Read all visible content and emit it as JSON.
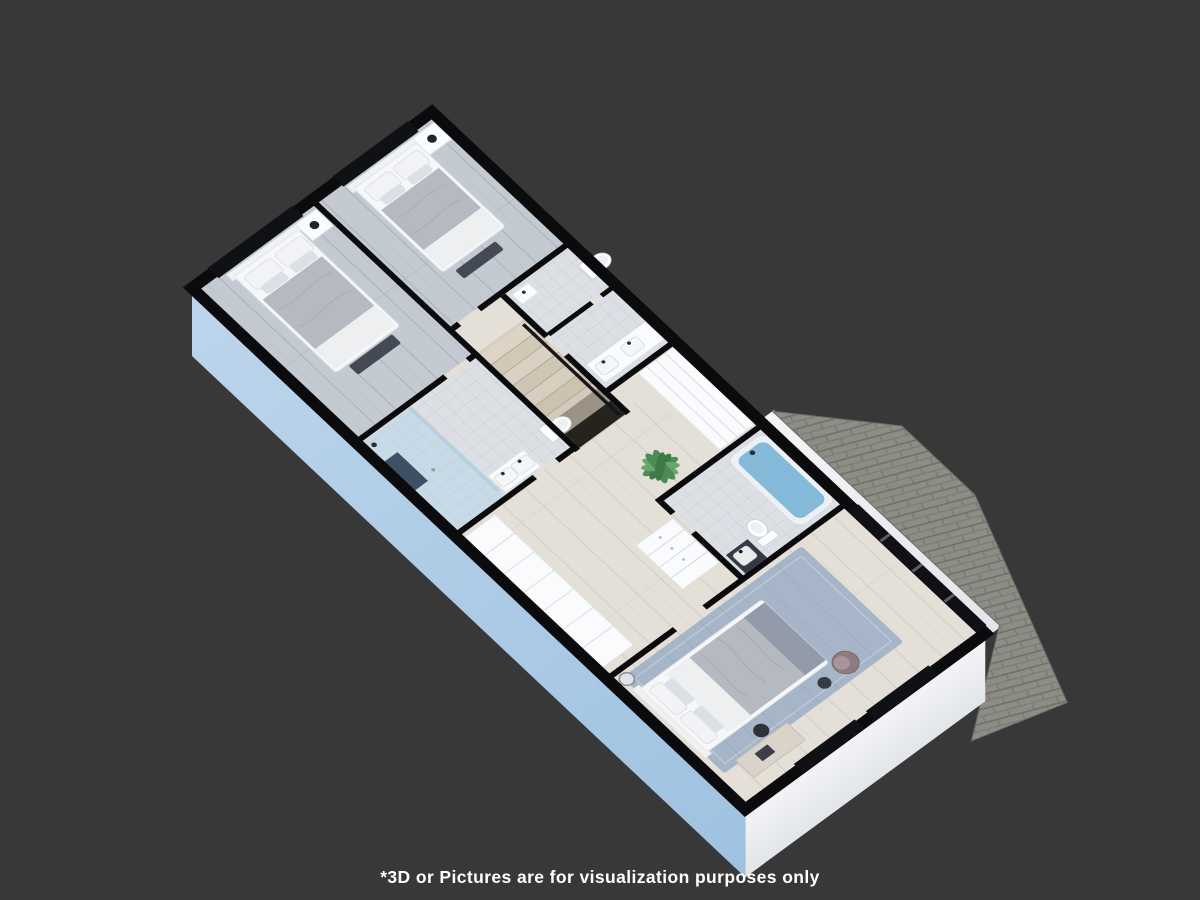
{
  "disclaimer": "*3D or Pictures are for visualization purposes only",
  "scene": {
    "type": "isometric-3d-floor-plan-render",
    "floor_shown": "upper floor with two bedrooms, three bathrooms, staircase, hallway and master bedroom",
    "colors": {
      "background": "#383838",
      "wall_cut": "#0b0b0d",
      "exterior_side_wall": "#a9c8e3",
      "exterior_end_wall": "#eef0f3",
      "roof_shingle": "#8d8c86",
      "floor_bedroom": "#c4cad2",
      "floor_hall": "#e4e0d8",
      "floor_bath": "#dce0e5",
      "bedding": "#b5b9c1",
      "rug": "#a6b5c7",
      "water": "#85b9da",
      "plant": "#4e8c57",
      "white_furniture": "#fafbfc",
      "dark_furniture": "#444954",
      "armchair": "#8e7b80"
    }
  }
}
